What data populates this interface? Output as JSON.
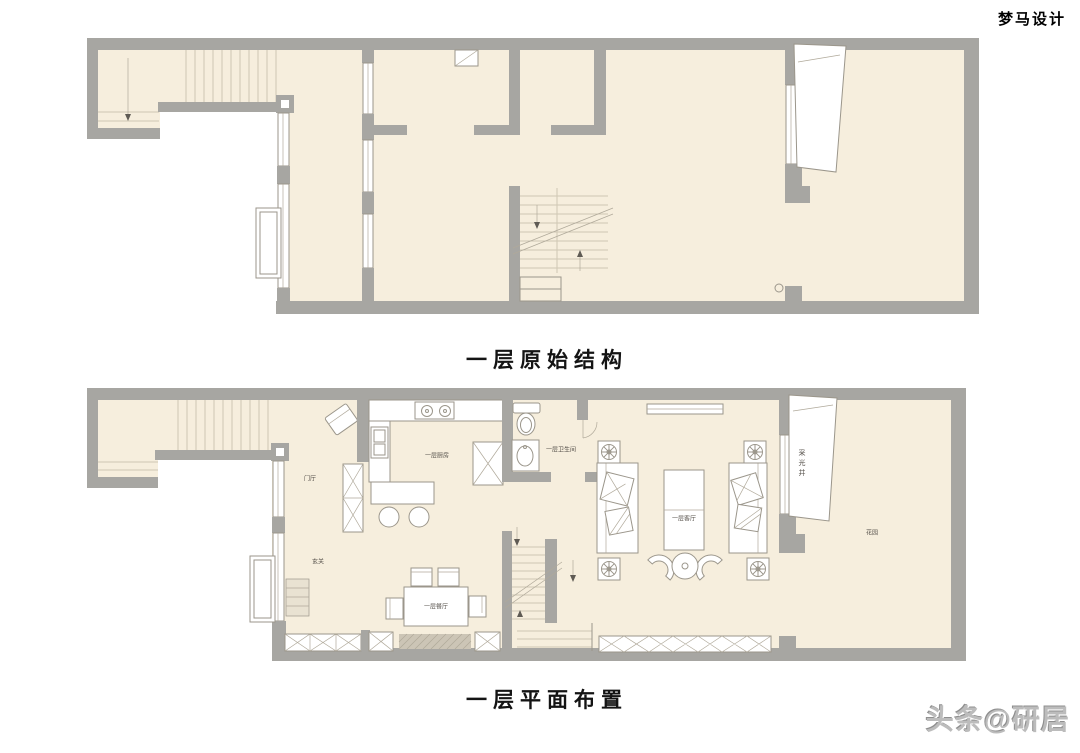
{
  "page": {
    "watermark_top_right": "梦马设计",
    "watermark_bottom_right": "头条@研居"
  },
  "plan_original": {
    "title": "一层原始结构"
  },
  "plan_layout": {
    "title": "一层平面布置",
    "labels": {
      "entry_hall": "门厅",
      "foyer": "玄关",
      "kitchen": "一层厨房",
      "bathroom": "一层卫生间",
      "dining": "一层餐厅",
      "living": "一层客厅",
      "light_well": "采光井",
      "garden": "花园"
    }
  },
  "colors": {
    "floor": "#f6eedd",
    "wall": "#a7a6a2",
    "furniture_line": "#9b968b",
    "stair_line": "#cfc7b4",
    "title_text": "#141414",
    "label_text": "#55504a",
    "watermark_bottom": "#bcbcbc"
  }
}
